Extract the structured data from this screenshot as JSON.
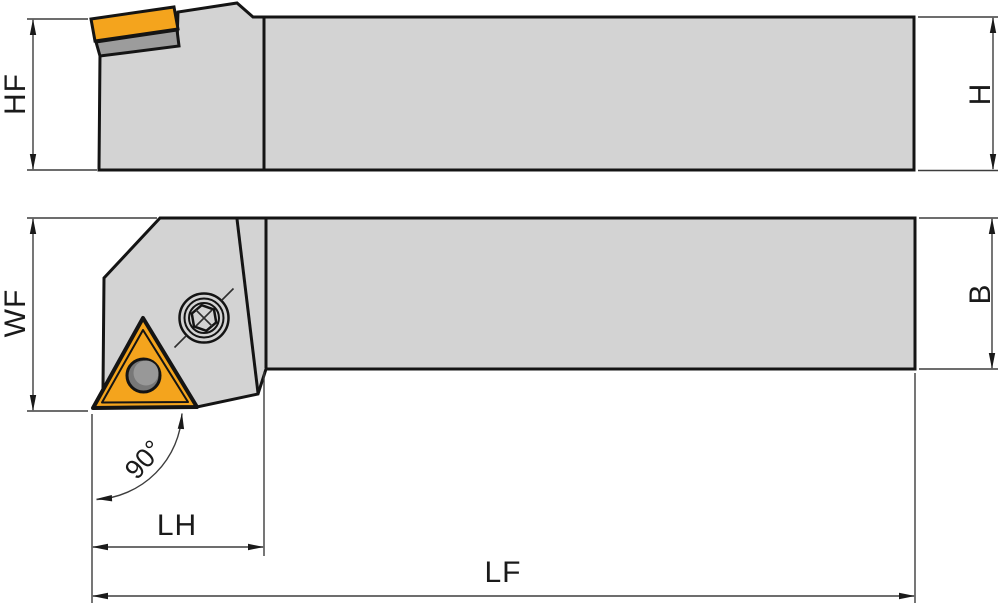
{
  "figure": {
    "labels": {
      "hf": "HF",
      "h": "H",
      "wf": "WF",
      "b": "B",
      "lh": "LH",
      "lf": "LF",
      "angle": "90°"
    },
    "colors": {
      "background": "#ffffff",
      "body_gray": "#d3d3d3",
      "shim_gray": "#9c9c9c",
      "insert_orange": "#f4a41d",
      "hole_dark": "#787878",
      "hole_light": "#989898",
      "screw_hex_gray": "#8a8a8a",
      "screw_center_gray": "#c9c9c9",
      "outline_black": "#141414",
      "dimension_gray": "#3d3d3d"
    }
  }
}
